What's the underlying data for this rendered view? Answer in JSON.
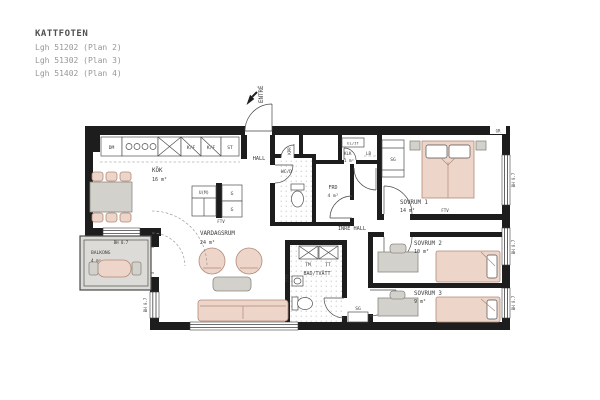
{
  "title_block": {
    "project": "KATTFOTEN",
    "units": [
      "Lgh 51202 (Plan 2)",
      "Lgh 51302 (Plan 3)",
      "Lgh 51402 (Plan 4)"
    ]
  },
  "plan": {
    "entrance_label": "ENTRÉ",
    "rooms": {
      "kok": {
        "name": "KÖK",
        "area": "16 m²"
      },
      "hall": {
        "name": "HALL"
      },
      "kpr": {
        "name": "KPR"
      },
      "wcd": {
        "name": "WC/D"
      },
      "frd": {
        "name": "FRD",
        "area": "4 m²"
      },
      "klk": {
        "name": "KLK",
        "area": "1 m²"
      },
      "sovrum1": {
        "name": "SOVRUM 1",
        "area": "14 m²"
      },
      "sovrum2": {
        "name": "SOVRUM 2",
        "area": "10 m²"
      },
      "sovrum3": {
        "name": "SOVRUM 3",
        "area": "9 m²"
      },
      "inre_hall": {
        "name": "INRE HALL"
      },
      "bad": {
        "name": "BAD/TVÄTT"
      },
      "vardagsrum": {
        "name": "VARDAGSRUM",
        "area": "24 m²"
      },
      "balkong": {
        "name": "BALKONG",
        "area": "4 m²"
      }
    },
    "fixtures": {
      "dm": "DM",
      "kf": "K/F",
      "st": "ST",
      "um": "U(M)",
      "g": "G",
      "elit": "EL/IT",
      "lb": "LB",
      "sg": "SG",
      "tm": "TM",
      "tt": "TT",
      "ftv": "FTV",
      "gr": "GR"
    },
    "window_label": "BH 0.7"
  },
  "colors": {
    "bg": "#ffffff",
    "wall": "#1d1d1d",
    "stroke": "#4f4f4f",
    "pink": "#eed5c9",
    "pinkStroke": "#b08a7a",
    "gray": "#d3d1cb",
    "grayStroke": "#8a8880",
    "balcony": "#dcdbd7",
    "tile": "#b5b3b5",
    "text": "#3c3c3c",
    "titleMain": "#4f4f4f",
    "titleSub": "#979797"
  }
}
